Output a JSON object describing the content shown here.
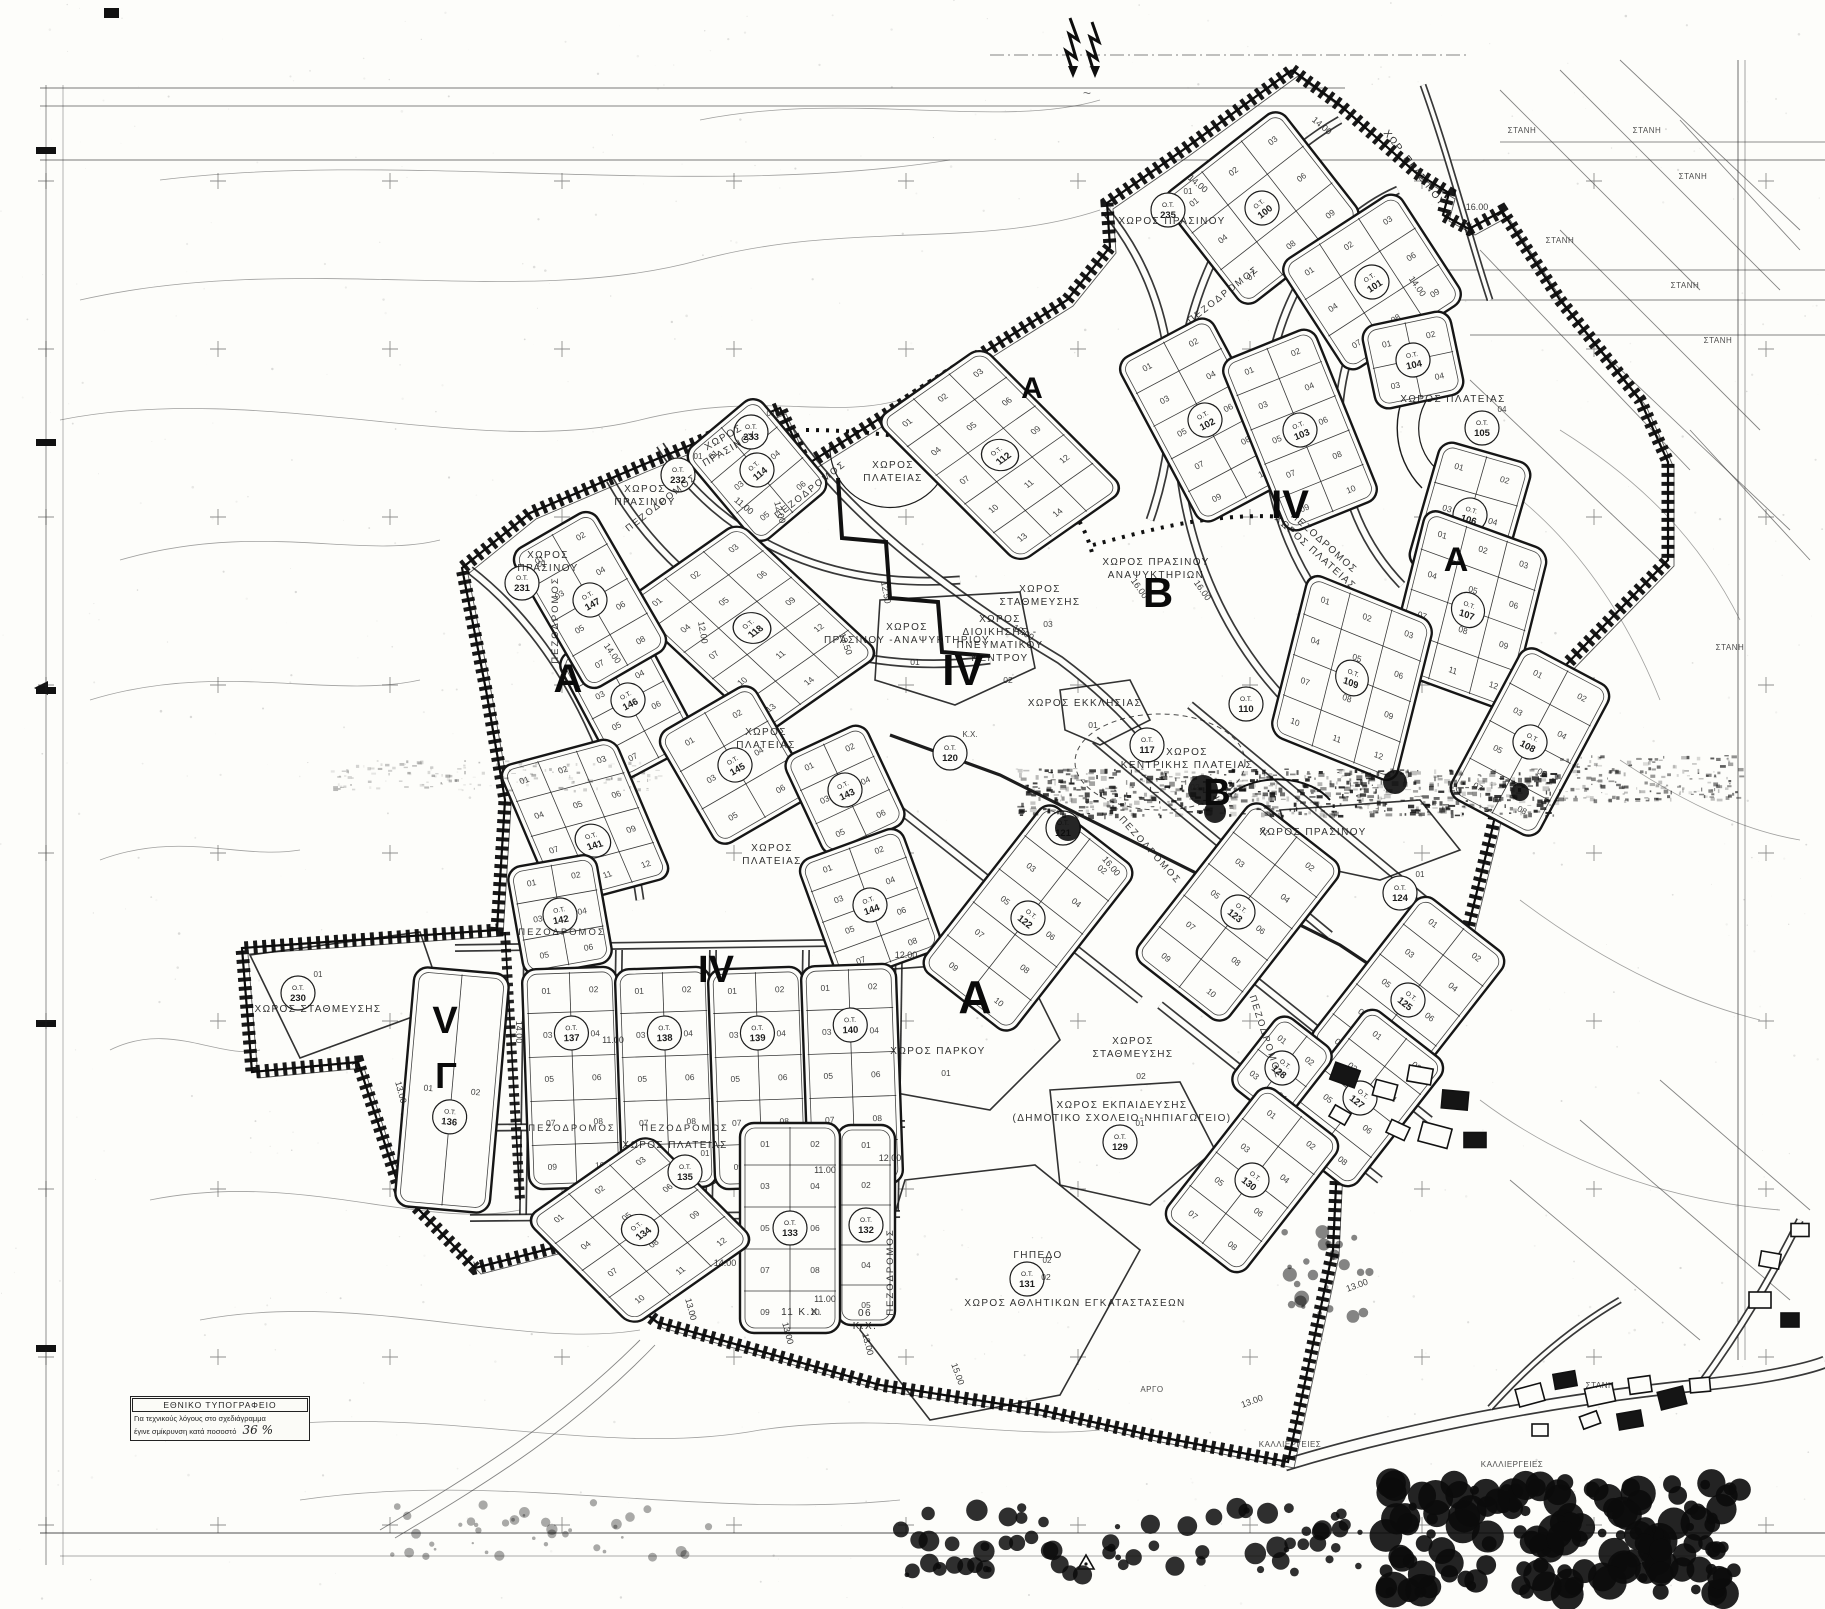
{
  "legend": {
    "title": "ΕΘΝΙΚΟ ΤΥΠΟΓΡΑΦΕΙΟ",
    "line1": "Για τεχνικούς λόγους στο σχεδιάγραμμα",
    "line2": "έγινε σμίκρυνση κατά ποσοστό",
    "value": "36 %"
  },
  "zone_letters": [
    {
      "t": "Α",
      "x": 1032,
      "y": 398,
      "s": 30
    },
    {
      "t": "IV",
      "x": 1290,
      "y": 518,
      "s": 40
    },
    {
      "t": "Α",
      "x": 1456,
      "y": 571,
      "s": 34
    },
    {
      "t": "Β",
      "x": 1158,
      "y": 607,
      "s": 42
    },
    {
      "t": "IV",
      "x": 963,
      "y": 685,
      "s": 44
    },
    {
      "t": "Α",
      "x": 568,
      "y": 692,
      "s": 40
    },
    {
      "t": "Β",
      "x": 1217,
      "y": 805,
      "s": 38
    },
    {
      "t": "IV",
      "x": 716,
      "y": 982,
      "s": 38
    },
    {
      "t": "V",
      "x": 445,
      "y": 1033,
      "s": 38
    },
    {
      "t": "Γ",
      "x": 446,
      "y": 1088,
      "s": 36
    },
    {
      "t": "Α",
      "x": 975,
      "y": 1013,
      "s": 46
    }
  ],
  "blocks": [
    {
      "ot": "100",
      "x": 1262,
      "y": 208,
      "r": -38,
      "w": 150,
      "h": 140,
      "c": 3,
      "rw": 3,
      "p": 9
    },
    {
      "ot": "101",
      "x": 1372,
      "y": 282,
      "r": -33,
      "w": 140,
      "h": 130,
      "c": 3,
      "rw": 3,
      "p": 9
    },
    {
      "ot": "102",
      "x": 1205,
      "y": 420,
      "r": -28,
      "w": 105,
      "h": 185,
      "c": 2,
      "rw": 5,
      "p": 10
    },
    {
      "ot": "103",
      "x": 1300,
      "y": 430,
      "r": -22,
      "w": 100,
      "h": 185,
      "c": 2,
      "rw": 5,
      "p": 10
    },
    {
      "ot": "104",
      "x": 1413,
      "y": 360,
      "r": -12,
      "w": 90,
      "h": 85,
      "c": 2,
      "rw": 2,
      "p": 4
    },
    {
      "ot": "106",
      "x": 1470,
      "y": 515,
      "r": 16,
      "w": 95,
      "h": 130,
      "c": 2,
      "rw": 3,
      "p": 6
    },
    {
      "ot": "107",
      "x": 1468,
      "y": 610,
      "r": 20,
      "w": 130,
      "h": 165,
      "c": 3,
      "rw": 4,
      "p": 12,
      "k": 6
    },
    {
      "ot": "108",
      "x": 1530,
      "y": 742,
      "r": 28,
      "w": 100,
      "h": 170,
      "c": 2,
      "rw": 4,
      "p": 8
    },
    {
      "ot": "109",
      "x": 1352,
      "y": 678,
      "r": 22,
      "w": 135,
      "h": 165,
      "c": 3,
      "rw": 4,
      "p": 12,
      "k": 8
    },
    {
      "ot": "112",
      "x": 1000,
      "y": 455,
      "r": -35,
      "w": 130,
      "h": 200,
      "c": 3,
      "rw": 5,
      "p": 14,
      "k": 10
    },
    {
      "ot": "114",
      "x": 757,
      "y": 470,
      "r": -40,
      "w": 95,
      "h": 120,
      "c": 2,
      "rw": 3,
      "p": 6
    },
    {
      "ot": "118",
      "x": 752,
      "y": 628,
      "r": -35,
      "w": 140,
      "h": 190,
      "c": 3,
      "rw": 5,
      "p": 14,
      "k": 12
    },
    {
      "ot": "146",
      "x": 628,
      "y": 700,
      "r": -28,
      "w": 90,
      "h": 140,
      "c": 2,
      "rw": 4,
      "p": 8
    },
    {
      "ot": "147",
      "x": 590,
      "y": 600,
      "r": -30,
      "w": 95,
      "h": 160,
      "c": 2,
      "rw": 4,
      "p": 8
    },
    {
      "ot": "145",
      "x": 735,
      "y": 765,
      "r": -30,
      "w": 110,
      "h": 130,
      "c": 2,
      "rw": 3,
      "p": 6
    },
    {
      "ot": "143",
      "x": 845,
      "y": 790,
      "r": -25,
      "w": 90,
      "h": 110,
      "c": 2,
      "rw": 3,
      "p": 6
    },
    {
      "ot": "144",
      "x": 870,
      "y": 905,
      "r": -20,
      "w": 110,
      "h": 130,
      "c": 2,
      "rw": 4,
      "p": 8
    },
    {
      "ot": "141",
      "x": 585,
      "y": 822,
      "r": -15,
      "w": 120,
      "h": 150,
      "c": 3,
      "rw": 4,
      "p": 12,
      "k": 8,
      "oy": 20
    },
    {
      "ot": "142",
      "x": 560,
      "y": 915,
      "r": -10,
      "w": 90,
      "h": 110,
      "c": 2,
      "rw": 3,
      "p": 6
    },
    {
      "ot": "122",
      "x": 1028,
      "y": 918,
      "r": 38,
      "w": 115,
      "h": 210,
      "c": 2,
      "rw": 5,
      "p": 10
    },
    {
      "ot": "123",
      "x": 1238,
      "y": 912,
      "r": 38,
      "w": 115,
      "h": 200,
      "c": 2,
      "rw": 5,
      "p": 10
    },
    {
      "ot": "125",
      "x": 1408,
      "y": 1000,
      "r": 38,
      "w": 110,
      "h": 190,
      "c": 2,
      "rw": 5,
      "p": 10
    },
    {
      "ot": "127",
      "x": 1360,
      "y": 1098,
      "r": 38,
      "w": 100,
      "h": 160,
      "c": 2,
      "rw": 4,
      "p": 8
    },
    {
      "ot": "128",
      "x": 1282,
      "y": 1068,
      "r": 38,
      "w": 70,
      "h": 90,
      "c": 2,
      "rw": 2,
      "p": 4
    },
    {
      "ot": "130",
      "x": 1252,
      "y": 1180,
      "r": 38,
      "w": 100,
      "h": 170,
      "c": 2,
      "rw": 4,
      "p": 8
    },
    {
      "ot": "137",
      "x": 573,
      "y": 1078,
      "r": -2,
      "w": 95,
      "h": 220,
      "c": 2,
      "rw": 5,
      "p": 10,
      "oy": -45
    },
    {
      "ot": "138",
      "x": 666,
      "y": 1078,
      "r": -2,
      "w": 95,
      "h": 220,
      "c": 2,
      "rw": 5,
      "p": 10,
      "oy": -45
    },
    {
      "ot": "139",
      "x": 759,
      "y": 1078,
      "r": -2,
      "w": 95,
      "h": 220,
      "c": 2,
      "rw": 5,
      "p": 10,
      "oy": -45
    },
    {
      "ot": "140",
      "x": 852,
      "y": 1075,
      "r": -2,
      "w": 95,
      "h": 220,
      "c": 2,
      "rw": 5,
      "p": 10,
      "oy": -50
    },
    {
      "ot": "132",
      "x": 866,
      "y": 1225,
      "r": 0,
      "w": 58,
      "h": 200,
      "c": 1,
      "rw": 5,
      "p": 5
    },
    {
      "ot": "133",
      "x": 790,
      "y": 1228,
      "r": 0,
      "w": 100,
      "h": 210,
      "c": 2,
      "rw": 5,
      "p": 10
    },
    {
      "ot": "134",
      "x": 640,
      "y": 1230,
      "r": -35,
      "w": 150,
      "h": 150,
      "c": 3,
      "rw": 4,
      "p": 12,
      "k": 10
    },
    {
      "ot": "136",
      "x": 452,
      "y": 1090,
      "r": 5,
      "w": 95,
      "h": 240,
      "c": 2,
      "rw": 1,
      "p": 2,
      "oy": 27
    }
  ],
  "circles": [
    {
      "n": "235",
      "x": 1168,
      "y": 210,
      "sub": "01"
    },
    {
      "n": "233",
      "x": 751,
      "y": 432,
      "sub": "01"
    },
    {
      "n": "232",
      "x": 678,
      "y": 475,
      "sub": "01"
    },
    {
      "n": "231",
      "x": 522,
      "y": 583,
      "sub": "01"
    },
    {
      "n": "230",
      "x": 298,
      "y": 993,
      "sub": "01"
    },
    {
      "n": "105",
      "x": 1482,
      "y": 428,
      "sub": "04"
    },
    {
      "n": "110",
      "x": 1246,
      "y": 704,
      "sub": ""
    },
    {
      "n": "117",
      "x": 1147,
      "y": 745,
      "sub": ""
    },
    {
      "n": "120",
      "x": 950,
      "y": 753,
      "sub": "Κ.Χ."
    },
    {
      "n": "121",
      "x": 1063,
      "y": 828,
      "sub": ""
    },
    {
      "n": "124",
      "x": 1400,
      "y": 893,
      "sub": "01"
    },
    {
      "n": "135",
      "x": 685,
      "y": 1172,
      "sub": "01"
    },
    {
      "n": "129",
      "x": 1120,
      "y": 1142,
      "sub": "01"
    },
    {
      "n": "131",
      "x": 1027,
      "y": 1279,
      "sub": "02"
    }
  ],
  "spaces": [
    {
      "lines": [
        "ΧΩΡΟΣ ΠΡΑΣΙΝΟΥ"
      ],
      "x": 1172,
      "y": 224,
      "r": 0
    },
    {
      "lines": [
        "ΧΩΡΟΣ",
        "ΠΡΑΣΙΝΟΥ"
      ],
      "x": 725,
      "y": 440,
      "r": -30
    },
    {
      "lines": [
        "ΧΩΡΟΣ",
        "ΠΡΑΣΙΝΟΥ"
      ],
      "x": 645,
      "y": 492,
      "r": 0
    },
    {
      "lines": [
        "ΧΩΡΟΣ",
        "ΠΡΑΣΙΝΟΥ"
      ],
      "x": 548,
      "y": 558,
      "r": 0
    },
    {
      "lines": [
        "ΧΩΡΟΣ ΠΡΑΣΙΝΟΥ"
      ],
      "x": 1313,
      "y": 835,
      "r": 0
    },
    {
      "lines": [
        "ΧΩΡ. ΠΡΑΣΙΝΟΥ"
      ],
      "x": 1412,
      "y": 170,
      "r": 52
    },
    {
      "lines": [
        "ΧΩΡΟΣ ΠΡΑΣΙΝΟΥ",
        "ΑΝΑΨΥΚΤΗΡΙΩΝ"
      ],
      "x": 1156,
      "y": 565,
      "r": 0
    },
    {
      "lines": [
        "ΧΩΡΟΣ",
        "ΠΡΑΣΙΝΟΥ -ΑΝΑΨΥΚΤΗΡΙΟΥ"
      ],
      "x": 907,
      "y": 630,
      "r": 0,
      "sub": "01"
    },
    {
      "lines": [
        "ΧΩΡΟΣ",
        "ΔΙΟΙΚΗΣΗΣ -",
        "ΠΝΕΥΜΑΤΙΚΟΥ",
        "ΚΕΝΤΡΟΥ"
      ],
      "x": 1000,
      "y": 622,
      "r": 0,
      "sub": "02"
    },
    {
      "lines": [
        "ΧΩΡΟΣ",
        "ΣΤΑΘΜΕΥΣΗΣ"
      ],
      "x": 1040,
      "y": 592,
      "r": 0,
      "sub": "03"
    },
    {
      "lines": [
        "ΧΩΡΟΣ",
        "ΣΤΑΘΜΕΥΣΗΣ"
      ],
      "x": 1133,
      "y": 1044,
      "r": 0,
      "sub": "02"
    },
    {
      "lines": [
        "ΧΩΡΟΣ ΣΤΑΘΜΕΥΣΗΣ"
      ],
      "x": 318,
      "y": 1012,
      "r": 0
    },
    {
      "lines": [
        "ΧΩΡΟΣ ΠΛΑΤΕΙΑΣ"
      ],
      "x": 1453,
      "y": 402,
      "r": 0
    },
    {
      "lines": [
        "ΧΩΡΟΣ",
        "ΠΛΑΤΕΙΑΣ"
      ],
      "x": 893,
      "y": 468,
      "r": 0
    },
    {
      "lines": [
        "ΧΩΡΟΣ",
        "ΠΛΑΤΕΙΑΣ"
      ],
      "x": 766,
      "y": 735,
      "r": 0
    },
    {
      "lines": [
        "ΧΩΡΟΣ",
        "ΠΛΑΤΕΙΑΣ"
      ],
      "x": 772,
      "y": 851,
      "r": 0
    },
    {
      "lines": [
        "ΧΩΡΟΣ ΠΛΑΤΕΙΑΣ"
      ],
      "x": 675,
      "y": 1148,
      "r": 0
    },
    {
      "lines": [
        "ΠΕΖΟΔΡΟΜΟΣ",
        "ΧΩΡΟΣ ΠΛΑΤΕΙΑΣ"
      ],
      "x": 1322,
      "y": 545,
      "r": 42
    },
    {
      "lines": [
        "ΧΩΡΟΣ",
        "ΚΕΝΤΡΙΚΗΣ  ΠΛΑΤΕΙΑΣ"
      ],
      "x": 1187,
      "y": 755,
      "r": 0,
      "sub": "02"
    },
    {
      "lines": [
        "ΧΩΡΟΣ ΕΚΚΛΗΣΙΑΣ"
      ],
      "x": 1085,
      "y": 706,
      "r": 0,
      "sub": "01"
    },
    {
      "lines": [
        "ΧΩΡΟΣ ΠΑΡΚΟΥ"
      ],
      "x": 938,
      "y": 1054,
      "r": 0,
      "sub": "01"
    },
    {
      "lines": [
        "ΧΩΡΟΣ  ΕΚΠΑΙΔΕΥΣΗΣ",
        "(ΔΗΜΟΤΙΚΟ ΣΧΟΛΕΙΟ-ΝΗΠΙΑΓΩΓΕΙΟ)"
      ],
      "x": 1122,
      "y": 1108,
      "r": 0
    },
    {
      "lines": [
        "ΧΩΡΟΣ ΑΘΛΗΤΙΚΩΝ ΕΓΚΑΤΑΣΤΑΣΕΩΝ"
      ],
      "x": 1075,
      "y": 1306,
      "r": 0
    },
    {
      "lines": [
        "ΓΗΠΕΔΟ"
      ],
      "x": 1038,
      "y": 1258,
      "r": 0,
      "sub": "02"
    },
    {
      "lines": [
        "06",
        "Κ.Χ."
      ],
      "x": 865,
      "y": 1316,
      "r": 0
    },
    {
      "lines": [
        "11   Κ.Χ."
      ],
      "x": 802,
      "y": 1315,
      "r": 0
    }
  ],
  "street_labels": [
    {
      "t": "ΠΕΖΟΔΡΟΜΟΣ",
      "x": 1225,
      "y": 297,
      "r": -38
    },
    {
      "t": "ΠΕΖΟΔΡΟΜΟΣ",
      "x": 663,
      "y": 505,
      "r": -38
    },
    {
      "t": "ΠΕΖΟΔΡΟΜΟΣ",
      "x": 812,
      "y": 492,
      "r": -38
    },
    {
      "t": "ΠΕΖΟΔΡΟΜΟΣ",
      "x": 558,
      "y": 620,
      "r": -90
    },
    {
      "t": "ΠΕΖΟΔΡΟΜΟΣ",
      "x": 562,
      "y": 935,
      "r": 0
    },
    {
      "t": "ΠΕΖΟΔΡΟΜΟΣ",
      "x": 685,
      "y": 1131,
      "r": 0
    },
    {
      "t": "ΠΕΖΟΔΡΟΜΟΣ",
      "x": 572,
      "y": 1131,
      "r": 0
    },
    {
      "t": "ΠΕΖΟΔΡΟΜΟΣ",
      "x": 893,
      "y": 1272,
      "r": -90
    },
    {
      "t": "ΠΕΖΟΔΡΟΜΟΣ",
      "x": 1148,
      "y": 852,
      "r": 48
    },
    {
      "t": "ΠΕΖΟΔΡΟΜΟΣ",
      "x": 1263,
      "y": 1038,
      "r": 72
    }
  ],
  "dims": [
    {
      "t": "14.00",
      "x": 1196,
      "y": 186,
      "r": 40
    },
    {
      "t": "14.00",
      "x": 1320,
      "y": 128,
      "r": 40
    },
    {
      "t": "16.00",
      "x": 1477,
      "y": 210,
      "r": 0
    },
    {
      "t": "14.00",
      "x": 1415,
      "y": 288,
      "r": 55
    },
    {
      "t": "16.00",
      "x": 1137,
      "y": 590,
      "r": 55
    },
    {
      "t": "16.00",
      "x": 1200,
      "y": 592,
      "r": 55
    },
    {
      "t": "18.00",
      "x": 1022,
      "y": 635,
      "r": 30
    },
    {
      "t": "13.50",
      "x": 843,
      "y": 645,
      "r": 70
    },
    {
      "t": "12.50",
      "x": 883,
      "y": 593,
      "r": 80
    },
    {
      "t": "14.00",
      "x": 610,
      "y": 655,
      "r": 55
    },
    {
      "t": "12.00",
      "x": 700,
      "y": 633,
      "r": 80
    },
    {
      "t": "11.00",
      "x": 742,
      "y": 508,
      "r": 40
    },
    {
      "t": "12.00",
      "x": 777,
      "y": 513,
      "r": 75
    },
    {
      "t": "11.00",
      "x": 613,
      "y": 1043,
      "r": 0
    },
    {
      "t": "11.00",
      "x": 825,
      "y": 1173,
      "r": 0
    },
    {
      "t": "12.00",
      "x": 890,
      "y": 1161,
      "r": 0
    },
    {
      "t": "11.00",
      "x": 825,
      "y": 1302,
      "r": 0
    },
    {
      "t": "14.00",
      "x": 725,
      "y": 1266,
      "r": 0
    },
    {
      "t": "13.00",
      "x": 688,
      "y": 1310,
      "r": 75
    },
    {
      "t": "13.00",
      "x": 785,
      "y": 1334,
      "r": 75
    },
    {
      "t": "13.00",
      "x": 865,
      "y": 1345,
      "r": 75
    },
    {
      "t": "15.00",
      "x": 955,
      "y": 1375,
      "r": 70
    },
    {
      "t": "13.00",
      "x": 398,
      "y": 1093,
      "r": 75
    },
    {
      "t": "16.00",
      "x": 1109,
      "y": 868,
      "r": 50
    },
    {
      "t": "14.00",
      "x": 516,
      "y": 1032,
      "r": 90
    },
    {
      "t": "13.00",
      "x": 1358,
      "y": 1288,
      "r": -20
    },
    {
      "t": "13.00",
      "x": 1253,
      "y": 1404,
      "r": -20
    },
    {
      "t": "12.00",
      "x": 906,
      "y": 958,
      "r": 0
    }
  ],
  "rural_labels": [
    {
      "t": "ΣΤΑΝΗ",
      "x": 1522,
      "y": 133
    },
    {
      "t": "ΣΤΑΝΗ",
      "x": 1647,
      "y": 133
    },
    {
      "t": "ΣΤΑΝΗ",
      "x": 1693,
      "y": 179
    },
    {
      "t": "ΣΤΑΝΗ",
      "x": 1560,
      "y": 243
    },
    {
      "t": "ΣΤΑΝΗ",
      "x": 1685,
      "y": 288
    },
    {
      "t": "ΣΤΑΝΗ",
      "x": 1718,
      "y": 343
    },
    {
      "t": "ΣΤΑΝΗ",
      "x": 1730,
      "y": 650
    },
    {
      "t": "ΣΤΑΝΗ",
      "x": 1600,
      "y": 1388
    },
    {
      "t": "ΚΑΛΛΙΕΡΓΕΙΕΣ",
      "x": 1290,
      "y": 1447
    },
    {
      "t": "ΚΑΛΛΙΕΡΓΕΙΕΣ",
      "x": 1512,
      "y": 1467
    },
    {
      "t": "ΑΡΓΟ",
      "x": 1152,
      "y": 1392
    }
  ]
}
